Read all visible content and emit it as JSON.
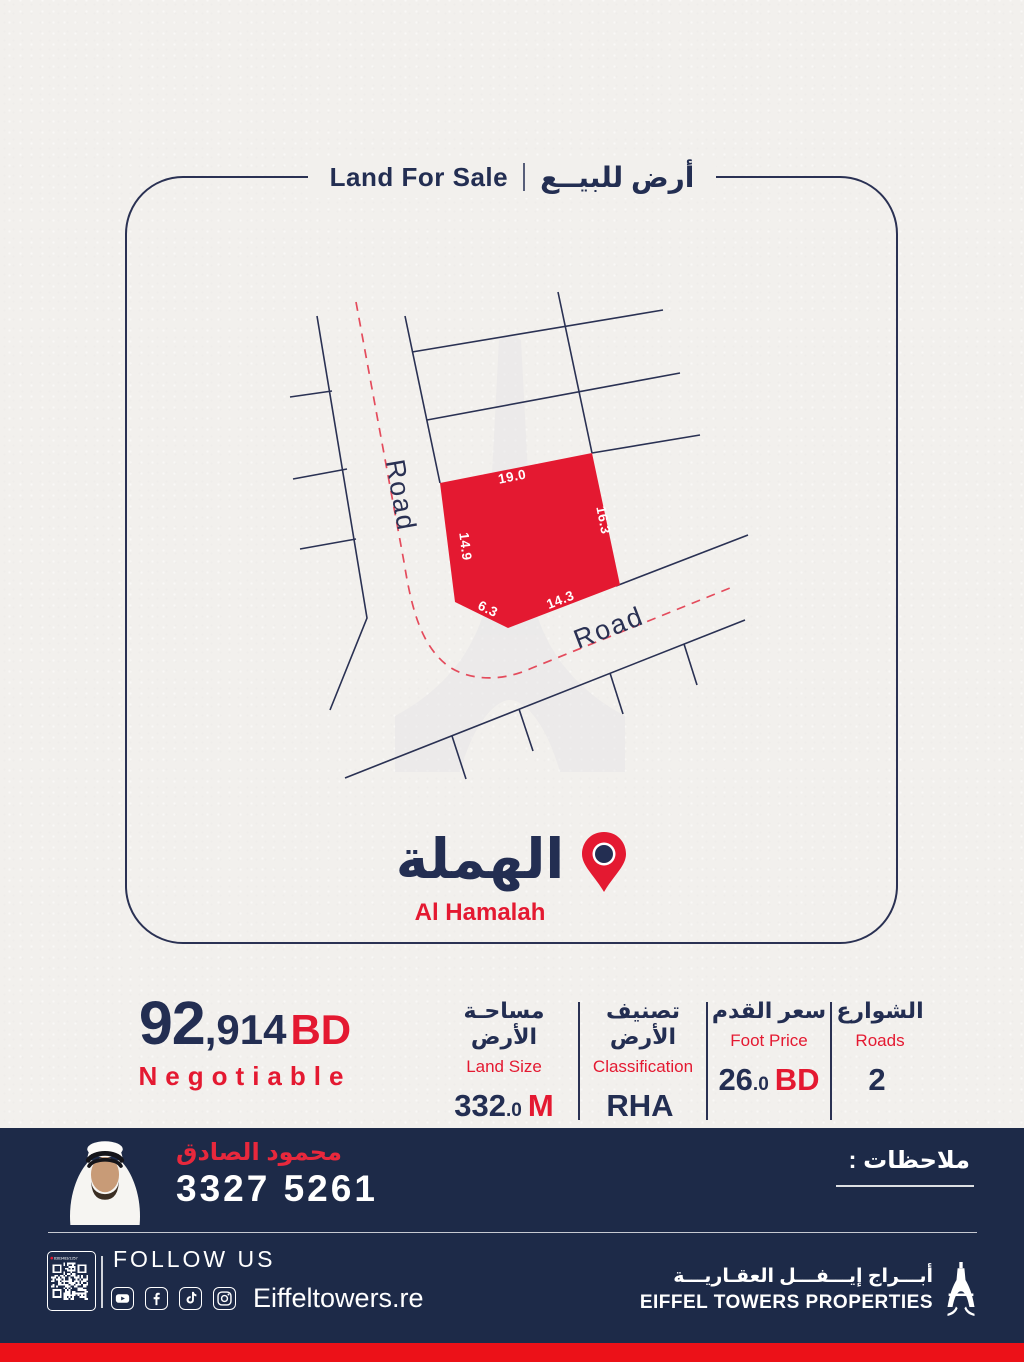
{
  "colors": {
    "navy": "#232e52",
    "navy_dark": "#1d2a48",
    "red": "#e41931",
    "red_strip": "#ec1118",
    "bg": "#f2f0ed",
    "plot_fill": "#e41931",
    "dash_red": "#e44b5c"
  },
  "header": {
    "title_en": "Land For Sale",
    "divider": "|",
    "title_ar": "أرض للبيــع"
  },
  "map": {
    "roads": {
      "left_label": "Road",
      "bottom_label": "Road"
    },
    "plot": {
      "top": "19.0",
      "right": "16.3",
      "bottom_right": "14.3",
      "bottom_left": "6.3",
      "left": "14.9"
    }
  },
  "location": {
    "ar": "الهملة",
    "en": "Al Hamalah"
  },
  "price": {
    "main": "92",
    "rest": ",914",
    "currency": "BD",
    "note": "Negotiable"
  },
  "details": [
    {
      "ar": "مساحـة الأرض",
      "en": "Land Size",
      "value": "332",
      "dec": ".0",
      "unit": "M"
    },
    {
      "ar": "تصنيف الأرض",
      "en": "Classification",
      "value": "RHA",
      "dec": "",
      "unit": ""
    },
    {
      "ar": "سعر القدم",
      "en": "Foot Price",
      "value": "26",
      "dec": ".0",
      "unit": "BD"
    },
    {
      "ar": "الشوارع",
      "en": "Roads",
      "value": "2",
      "dec": "",
      "unit": ""
    }
  ],
  "agent": {
    "name_ar": "محمود الصادق",
    "phone": "3327 5261",
    "notes_ar": "ملاحظات :"
  },
  "footer": {
    "qr_label": "8363483/1257",
    "follow_us": "FOLLOW US",
    "website": "Eiffeltowers.re",
    "social": [
      {
        "name": "youtube"
      },
      {
        "name": "facebook"
      },
      {
        "name": "tiktok"
      },
      {
        "name": "instagram"
      }
    ],
    "brand_ar": "أبـــراج إيـــفـــل العقـاريـــة",
    "brand_en": "EIFFEL TOWERS PROPERTIES"
  }
}
